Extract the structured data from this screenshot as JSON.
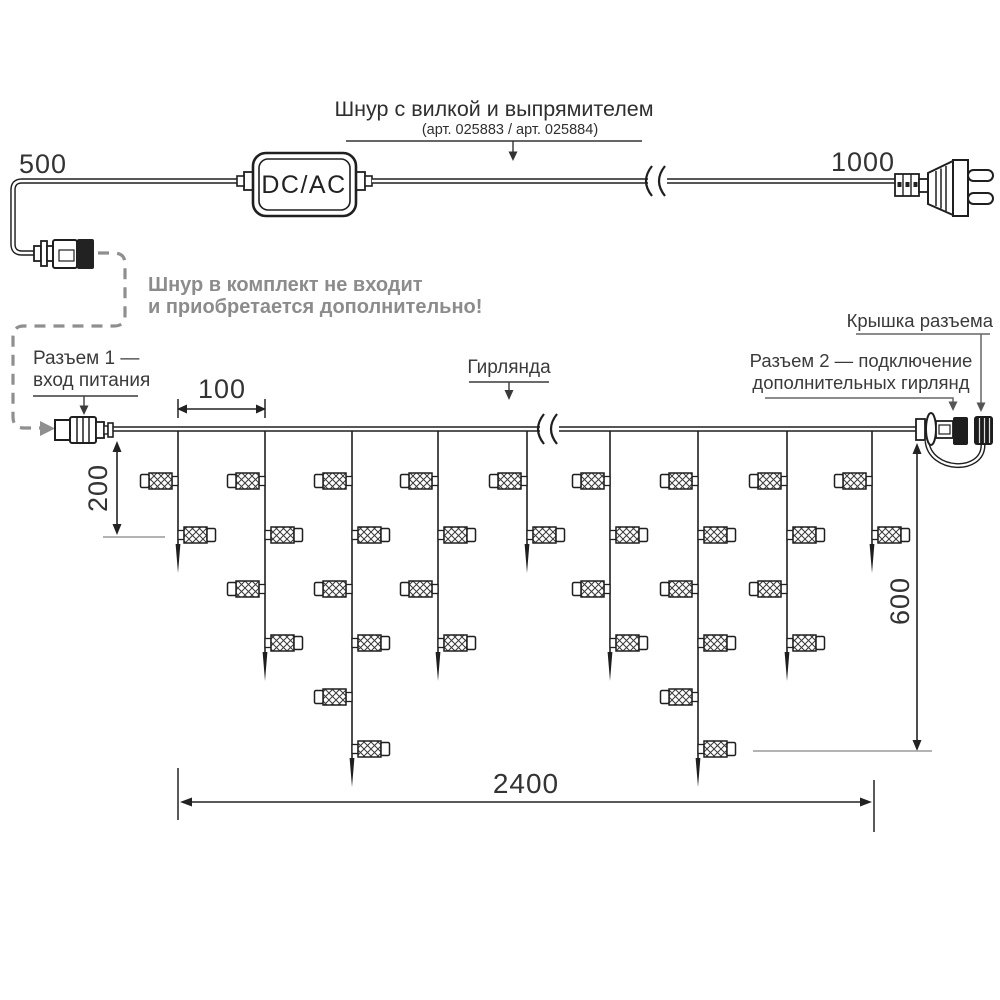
{
  "title_block": {
    "cord_title": "Шнур с вилкой и выпрямителем",
    "cord_subtitle": "(арт. 025883 / арт. 025884)"
  },
  "adapter": {
    "label": "DC/AC"
  },
  "dimensions": {
    "cord_left": "500",
    "cord_right": "1000",
    "drop_spacing": "100",
    "short_drop": "200",
    "long_drop": "600",
    "garland_length": "2400"
  },
  "note": {
    "line1": "Шнур в комплект не входит",
    "line2": "и приобретается дополнительно!"
  },
  "callouts": {
    "connector1_line1": "Разъем 1 —",
    "connector1_line2": "вход питания",
    "garland": "Гирлянда",
    "connector_cap": "Крышка разъема",
    "connector2_line1": "Разъем 2 — подключение",
    "connector2_line2": "дополнительных гирлянд"
  },
  "garland": {
    "wire_y": 429,
    "drop_xs": [
      178,
      265,
      352,
      438,
      527,
      610,
      698,
      787,
      872
    ],
    "lamps_per_drop": [
      2,
      4,
      6,
      4,
      2,
      4,
      6,
      4,
      2
    ],
    "lamp_row_ys": [
      481,
      535,
      589,
      643,
      697,
      749
    ]
  },
  "colors": {
    "line": "#1f1f1f",
    "gray": "#8f8f8f",
    "leader": "#666666",
    "reference": "#9a9a9a"
  }
}
